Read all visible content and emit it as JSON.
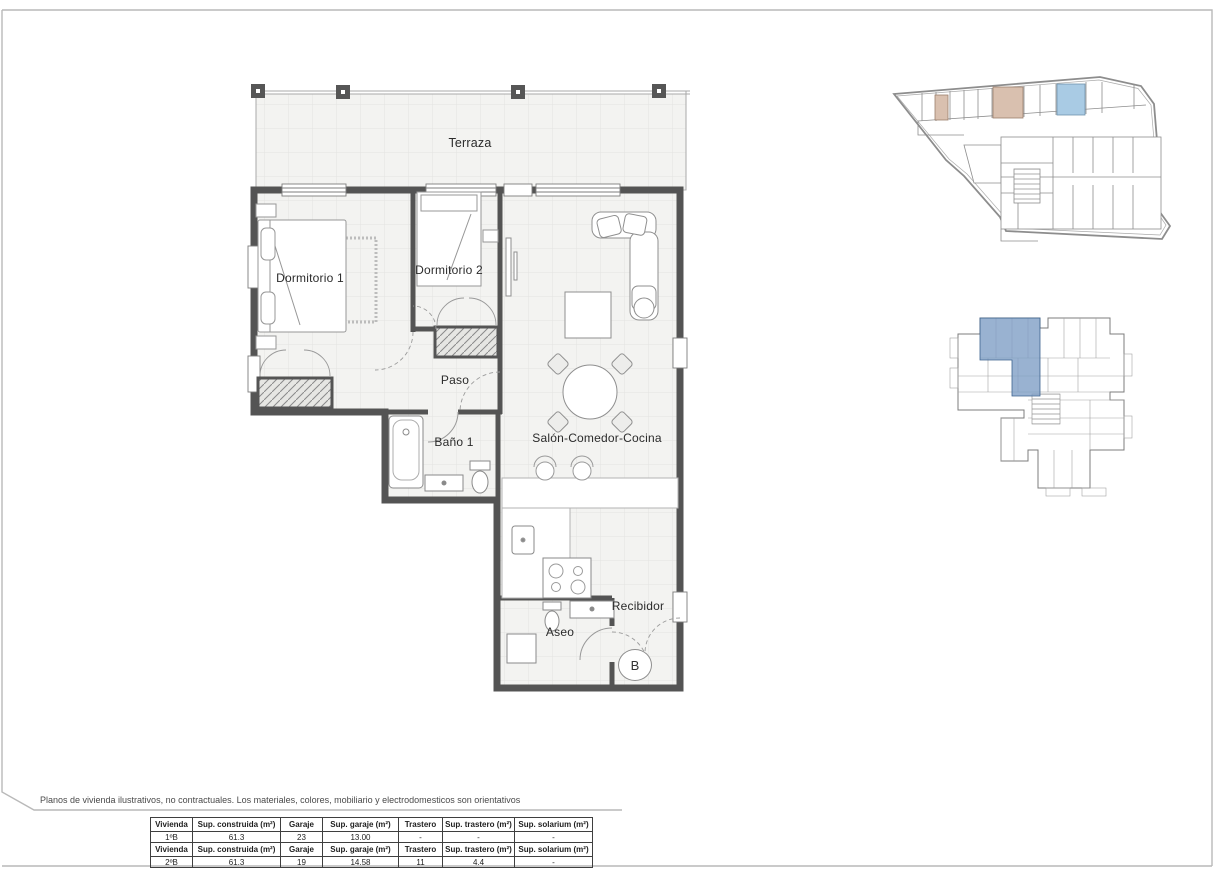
{
  "page": {
    "disclaimer": "Planos de vivienda ilustrativos, no contractuales. Los materiales, colores, mobiliario y electrodomesticos son orientativos"
  },
  "floorplan": {
    "rooms": {
      "terraza": "Terraza",
      "dormitorio1": "Dormitorio 1",
      "dormitorio2": "Dormitorio 2",
      "paso": "Paso",
      "bano1": "Baño 1",
      "salon": "Salón-Comedor-Cocina",
      "recibidor": "Recibidor",
      "aseo": "Aseo"
    },
    "unit_badge": "B"
  },
  "colors": {
    "wall_dark": "#545454",
    "highlight_blue": "#a9cbe4",
    "highlight_tan": "#d9c0af",
    "keyplan_blue": "#7f9fc5",
    "header_blue": "#ddeef7",
    "header_tan": "#f6e8dc"
  },
  "table": {
    "headers": [
      "Vivienda",
      "Sup. construida (m²)",
      "Garaje",
      "Sup. garaje (m²)",
      "Trastero",
      "Sup. trastero (m²)",
      "Sup. solarium (m²)"
    ],
    "rows": [
      [
        "1ºB",
        "61.3",
        "23",
        "13.00",
        "-",
        "-",
        "-"
      ],
      [
        "2ºB",
        "61.3",
        "19",
        "14.58",
        "11",
        "4.4",
        "-"
      ]
    ]
  }
}
